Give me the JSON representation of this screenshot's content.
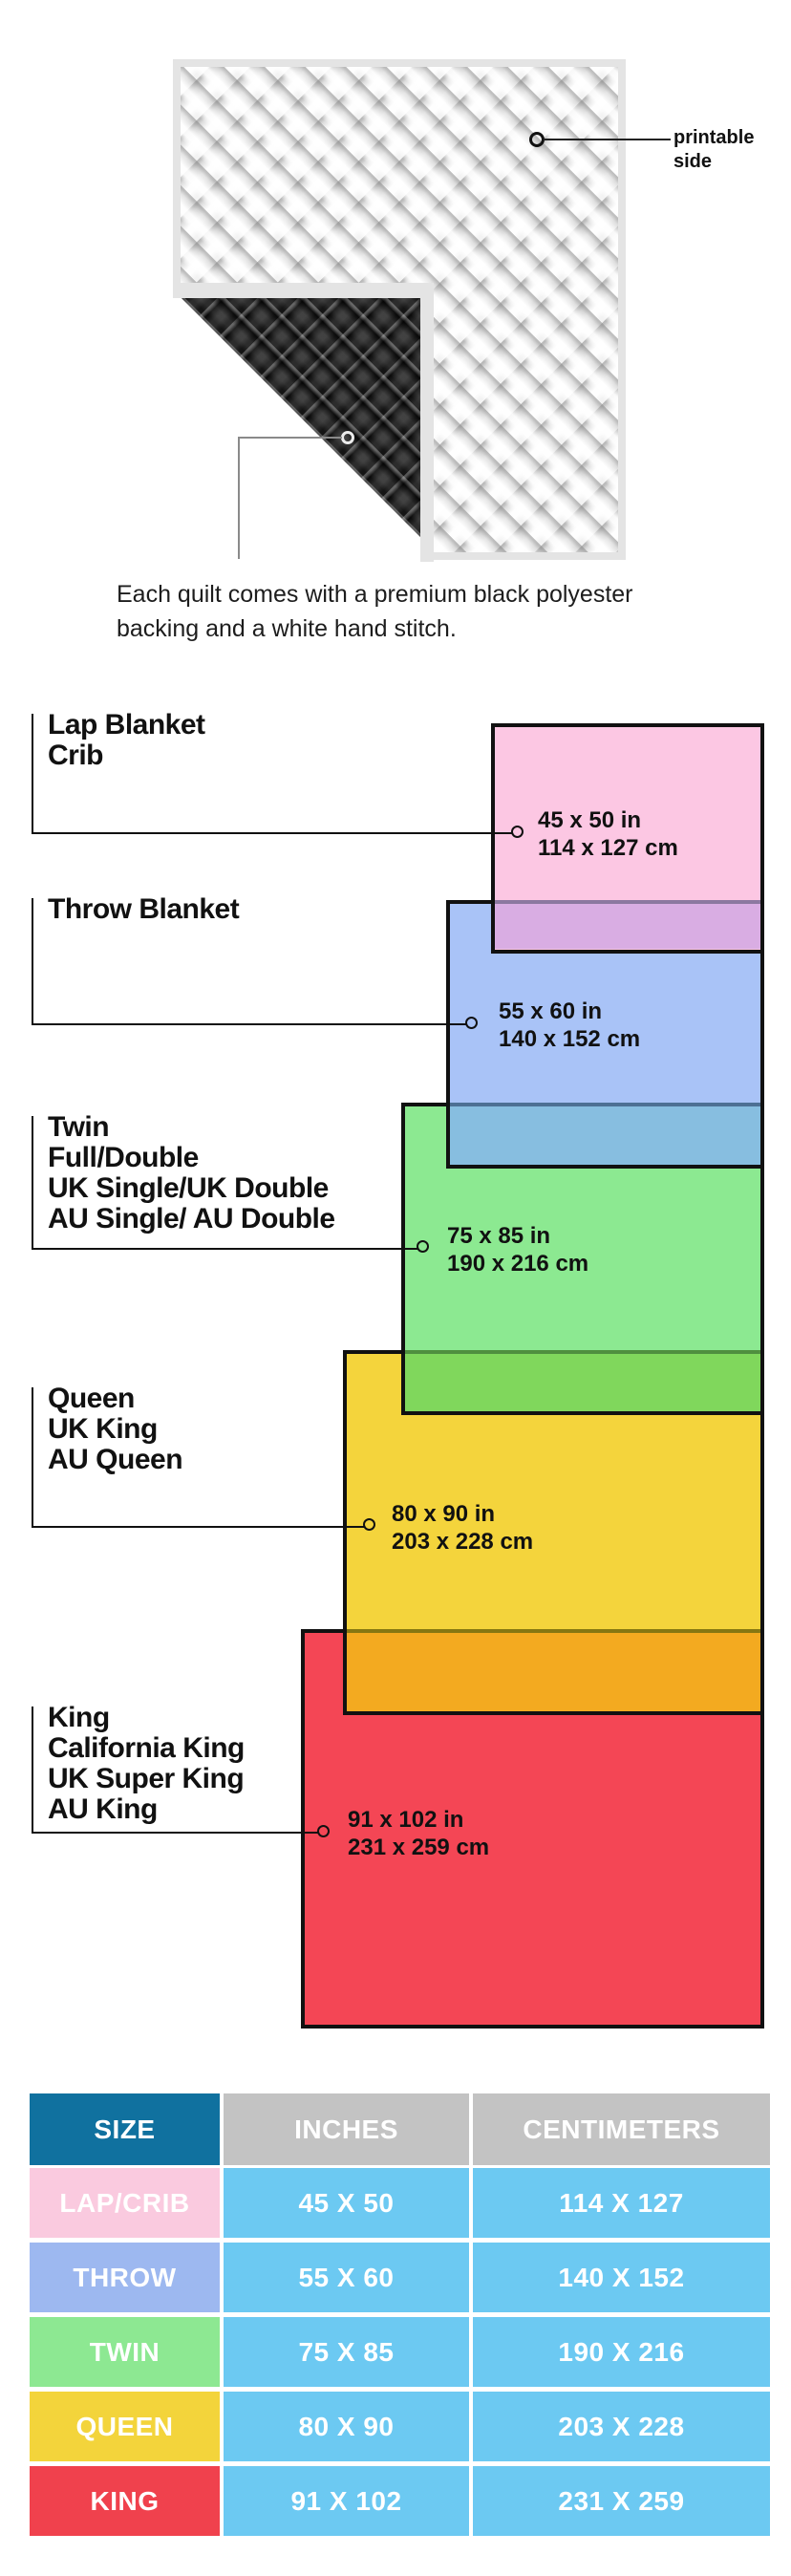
{
  "quilt": {
    "printable_label": "printable\nside",
    "caption": "Each quilt comes with a premium black polyester\nbacking and a white hand stitch.",
    "front_color": "#f3f3f3",
    "backing_color": "#141414",
    "binding_color": "#e4e4e4"
  },
  "diagram": {
    "sizes": [
      {
        "id": "lap",
        "label": "Lap Blanket\nCrib",
        "inches": "45 x 50 in",
        "cm": "114 x 127 cm",
        "color": "#FCC7E3",
        "overlap_color": "#D9ADE3",
        "overlap_line": "#8C78A0"
      },
      {
        "id": "throw",
        "label": "Throw Blanket",
        "inches": "55 x 60 in",
        "cm": "140 x 152 cm",
        "color": "#A9C3F7",
        "overlap_color": "#87BEE0",
        "overlap_line": "#4D7094"
      },
      {
        "id": "twin",
        "label": "Twin\nFull/Double\nUK Single/UK Double\nAU Single/ AU Double",
        "inches": "75 x 85 in",
        "cm": "190 x 216 cm",
        "color": "#8CE991",
        "overlap_color": "#80D75C",
        "overlap_line": "#4F8F3F"
      },
      {
        "id": "queen",
        "label": "Queen\nUK King\nAU Queen",
        "inches": "80 x 90 in",
        "cm": "203 x 228 cm",
        "color": "#F4D43C",
        "overlap_color": "#F3AA20",
        "overlap_line": "#857712"
      },
      {
        "id": "king",
        "label": "King\nCalifornia King\nUK Super King\nAU King",
        "inches": "91 x 102 in",
        "cm": "231 x 259 cm",
        "color": "#F44655",
        "overlap_color": null,
        "overlap_line": null
      }
    ]
  },
  "table": {
    "header": {
      "size": "SIZE",
      "inches": "INCHES",
      "centimeters": "CENTIMETERS",
      "size_bg": "#10719F",
      "header_bg": "#C3C3C3",
      "value_bg": "#6CC9F2"
    },
    "rows": [
      {
        "name": "LAP/CRIB",
        "inches": "45 X 50",
        "cm": "114 X 127",
        "color": "#FACADF"
      },
      {
        "name": "THROW",
        "inches": "55 X 60",
        "cm": "140 X 152",
        "color": "#9DB8F0"
      },
      {
        "name": "TWIN",
        "inches": "75 X 85",
        "cm": "190 X 216",
        "color": "#8DE892"
      },
      {
        "name": "QUEEN",
        "inches": "80 X 90",
        "cm": "203 X 228",
        "color": "#F3D43B"
      },
      {
        "name": "KING",
        "inches": "91 X 102",
        "cm": "231 X 259",
        "color": "#F0414D"
      }
    ]
  }
}
